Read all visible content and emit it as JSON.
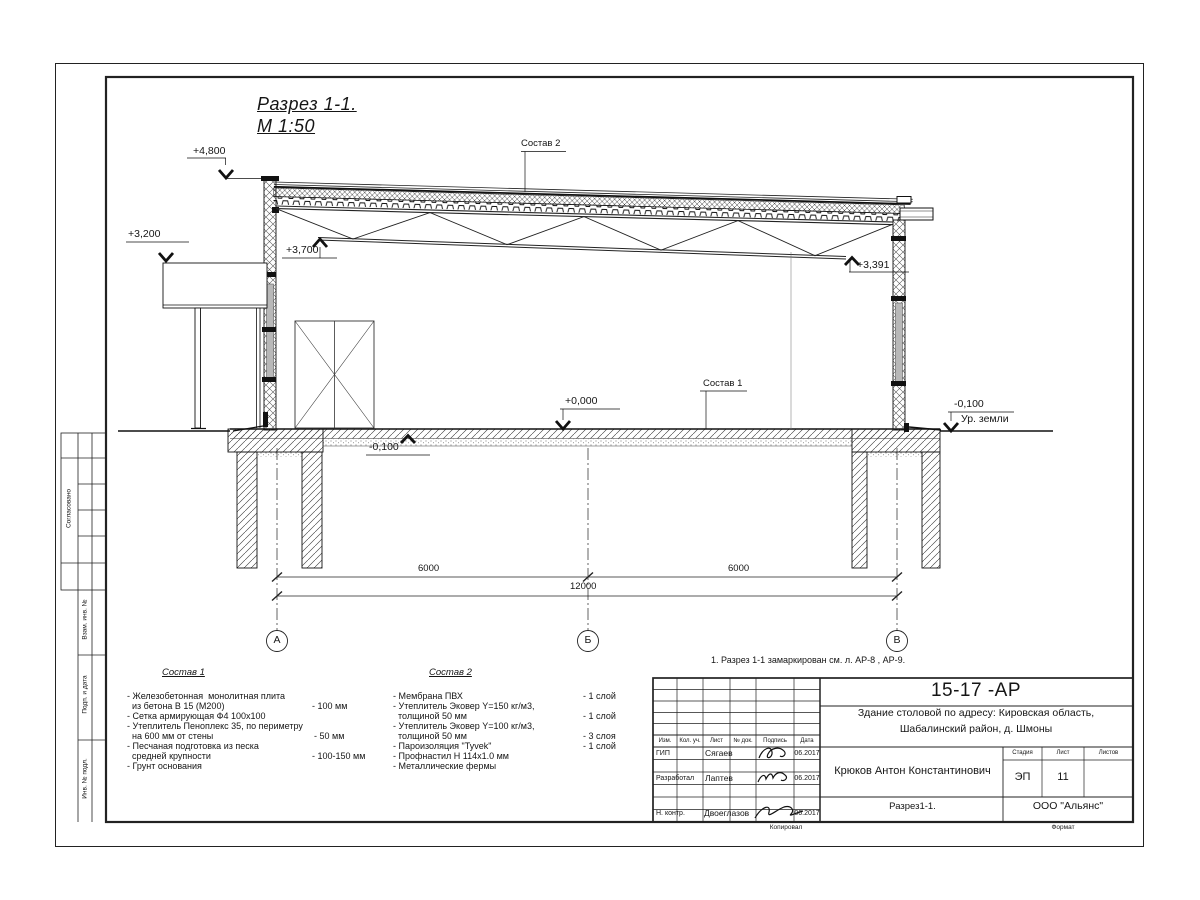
{
  "sheet": {
    "title": {
      "line1": "Разрез 1-1.",
      "line2": "М 1:50"
    },
    "elevation_marks": {
      "p4800": "+4,800",
      "p3200": "+3,200",
      "p3700": "+3,700",
      "p3391": "+3,391",
      "p0000": "+0,000",
      "m0100_left": "-0,100",
      "m0100_right": "-0,100",
      "ground_level": "Ур. земли"
    },
    "callouts": {
      "sostav1": "Состав 1",
      "sostav2": "Состав 2"
    },
    "dimensions": {
      "span1": "6000",
      "span2": "6000",
      "total": "12000"
    },
    "axes": {
      "a": "А",
      "b": "Б",
      "v": "В"
    },
    "note": "1. Разрез 1-1 замаркирован см. л. АР-8 , АР-9."
  },
  "legend_sostav1": {
    "title": "Состав 1",
    "rows": [
      {
        "text": "- Железобетонная  монолитная плита",
        "value": ""
      },
      {
        "text": "  из бетона В 15 (М200)",
        "value": "- 100 мм"
      },
      {
        "text": "- Сетка армирующая Ф4 100х100",
        "value": ""
      },
      {
        "text": "- Утеплитель Пеноплекс 35, по периметру",
        "value": ""
      },
      {
        "text": "  на 600 мм от стены",
        "value": "- 50 мм"
      },
      {
        "text": "- Песчаная подготовка из песка",
        "value": ""
      },
      {
        "text": "  средней крупности",
        "value": "- 100-150 мм"
      },
      {
        "text": "- Грунт основания",
        "value": ""
      }
    ]
  },
  "legend_sostav2": {
    "title": "Состав 2",
    "rows": [
      {
        "text": "- Мембрана ПВХ",
        "value": "- 1 слой"
      },
      {
        "text": "- Утеплитель Эковер Y=150 кг/м3,",
        "value": ""
      },
      {
        "text": "  толщиной 50 мм",
        "value": "- 1 слой"
      },
      {
        "text": "- Утеплитель Эковер Y=100 кг/м3,",
        "value": ""
      },
      {
        "text": "  толщиной 50 мм",
        "value": "- 3 слоя"
      },
      {
        "text": "- Пароизоляция \"Tyvek\"",
        "value": "- 1 слой"
      },
      {
        "text": "- Профнастил Н 114х1.0 мм",
        "value": ""
      },
      {
        "text": "- Металлические фермы",
        "value": ""
      }
    ]
  },
  "title_block": {
    "doc_number": "15-17 -АР",
    "project_line1": "Здание столовой по адресу: Кировская область,",
    "project_line2": "Шабалинский район, д. Шмоны",
    "architect": "Крюков Антон Константинович",
    "stage_label": "Стадия",
    "sheet_label": "Лист",
    "sheets_label": "Листов",
    "stage": "ЭП",
    "sheet_no": "11",
    "sheets_total": "",
    "drawing_name": "Разрез1-1.",
    "company": "ООО \"Альянс\"",
    "cols": {
      "izm": "Изм.",
      "kol": "Кол. уч.",
      "list": "Лист",
      "doc": "№ док.",
      "sign": "Подпись",
      "date": "Дата"
    },
    "rows": [
      {
        "role": "ГИП",
        "name": "Сягаев",
        "date": "06.2017"
      },
      {
        "role": "Разработал",
        "name": "Лаптев",
        "date": "06.2017"
      },
      {
        "role": "Н. контр.",
        "name": "Двоеглазов",
        "date": "06.2017"
      }
    ],
    "footer": {
      "copied": "Копировал",
      "format": "Формат"
    }
  },
  "side_stamp": {
    "agreed": "Согласовано",
    "vzam": "Взам. инв. №",
    "podp": "Подп. и дата",
    "inv": "Инв. № подл."
  },
  "colors": {
    "ink": "#151515",
    "glass": "#b8b8b8",
    "paper": "#ffffff"
  }
}
